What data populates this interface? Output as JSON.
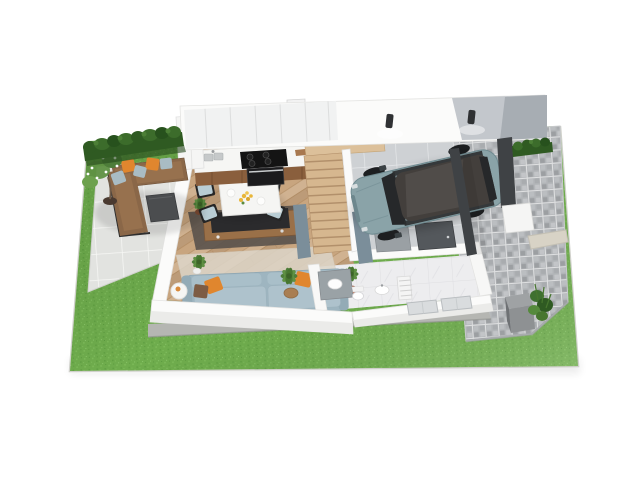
{
  "scene": {
    "type": "3d-floor-plan-render",
    "description": "Isometric 3D architectural rendering of a house ground floor with garden lawn, side terrace, living room, kitchen, staircase, hallway, bathroom, carport with parked SUV and paved driveway",
    "visible_text": "none",
    "background": "#ffffff"
  },
  "palette": {
    "bg": "#ffffff",
    "grass": "#6fad4d",
    "grass_edge": "#cbccc5",
    "hedge": "#2f5a22",
    "hedge_light": "#4c7f36",
    "paver": "#b2b5b8",
    "paver_gap": "#dfe0e1",
    "walkway": "#d8d3c6",
    "carport_slab": "#ced1d4",
    "patio_tile": "#e2e3e0",
    "concrete": "#b5b6b2",
    "wood_floor": "#c8a57f",
    "stair_wood": "#d6b78f",
    "marble": "#ededef",
    "wall_white": "#fbfbfa",
    "wall_shade": "#ebebe9",
    "slate": "#7b8e9a",
    "ceiling": "#c3c7cc",
    "fence": "#3f4245",
    "lamp": "#2f3133",
    "car_body": "#8aa3a8",
    "car_roof": "#433f3c",
    "car_glass": "#26282a",
    "sofa_indoor": "#9eb5c0",
    "sofa_cushion": "#aec2cc",
    "sofa_outdoor": "#8a6748",
    "outdoor_cushion": "#97714e",
    "pillow_orange": "#e0862e",
    "pillow_blue": "#a9bcc4",
    "pillow_brown": "#7d5c44",
    "table_white": "#f5f5f3",
    "chair_seat": "#b9cdd4",
    "chair_frame": "#262626",
    "console_wood": "#9a7048",
    "console_top": "#2b2b2d",
    "rug_light": "#ddd6c9",
    "rug_dark": "#5b544d",
    "cabinet_wood": "#8a5f3d",
    "counter_white": "#f6f6f4",
    "cooktop": "#141414",
    "wardrobe": "#9aa0a4",
    "door": "#54585c",
    "vanity": "#9aa2a6",
    "fixture_white": "#fdfdfd",
    "plant_green": "#4e7d3a",
    "plant_light": "#5f9143",
    "pot_terracotta": "#b5684a",
    "basket": "#a97e52",
    "pillar": "#8e9193"
  },
  "objects": [
    "garden lawn",
    "boxwood hedges",
    "flowering tree",
    "outdoor corner sofa with orange and grey cushions",
    "outdoor coffee table",
    "terrace patio",
    "kitchen with sink, hob and oven",
    "dining table with four chairs",
    "TV sideboard",
    "staircase with white railing",
    "grey-blue sofa with orange and brown pillows",
    "round side table",
    "potted plants",
    "hallway wardrobes",
    "entry door",
    "bathroom with vanity, toilet, basin and towel radiator",
    "front windows",
    "carport with SUV",
    "ceiling spotlights",
    "paved driveway",
    "garden path",
    "gate pillar",
    "ornamental shrub"
  ]
}
